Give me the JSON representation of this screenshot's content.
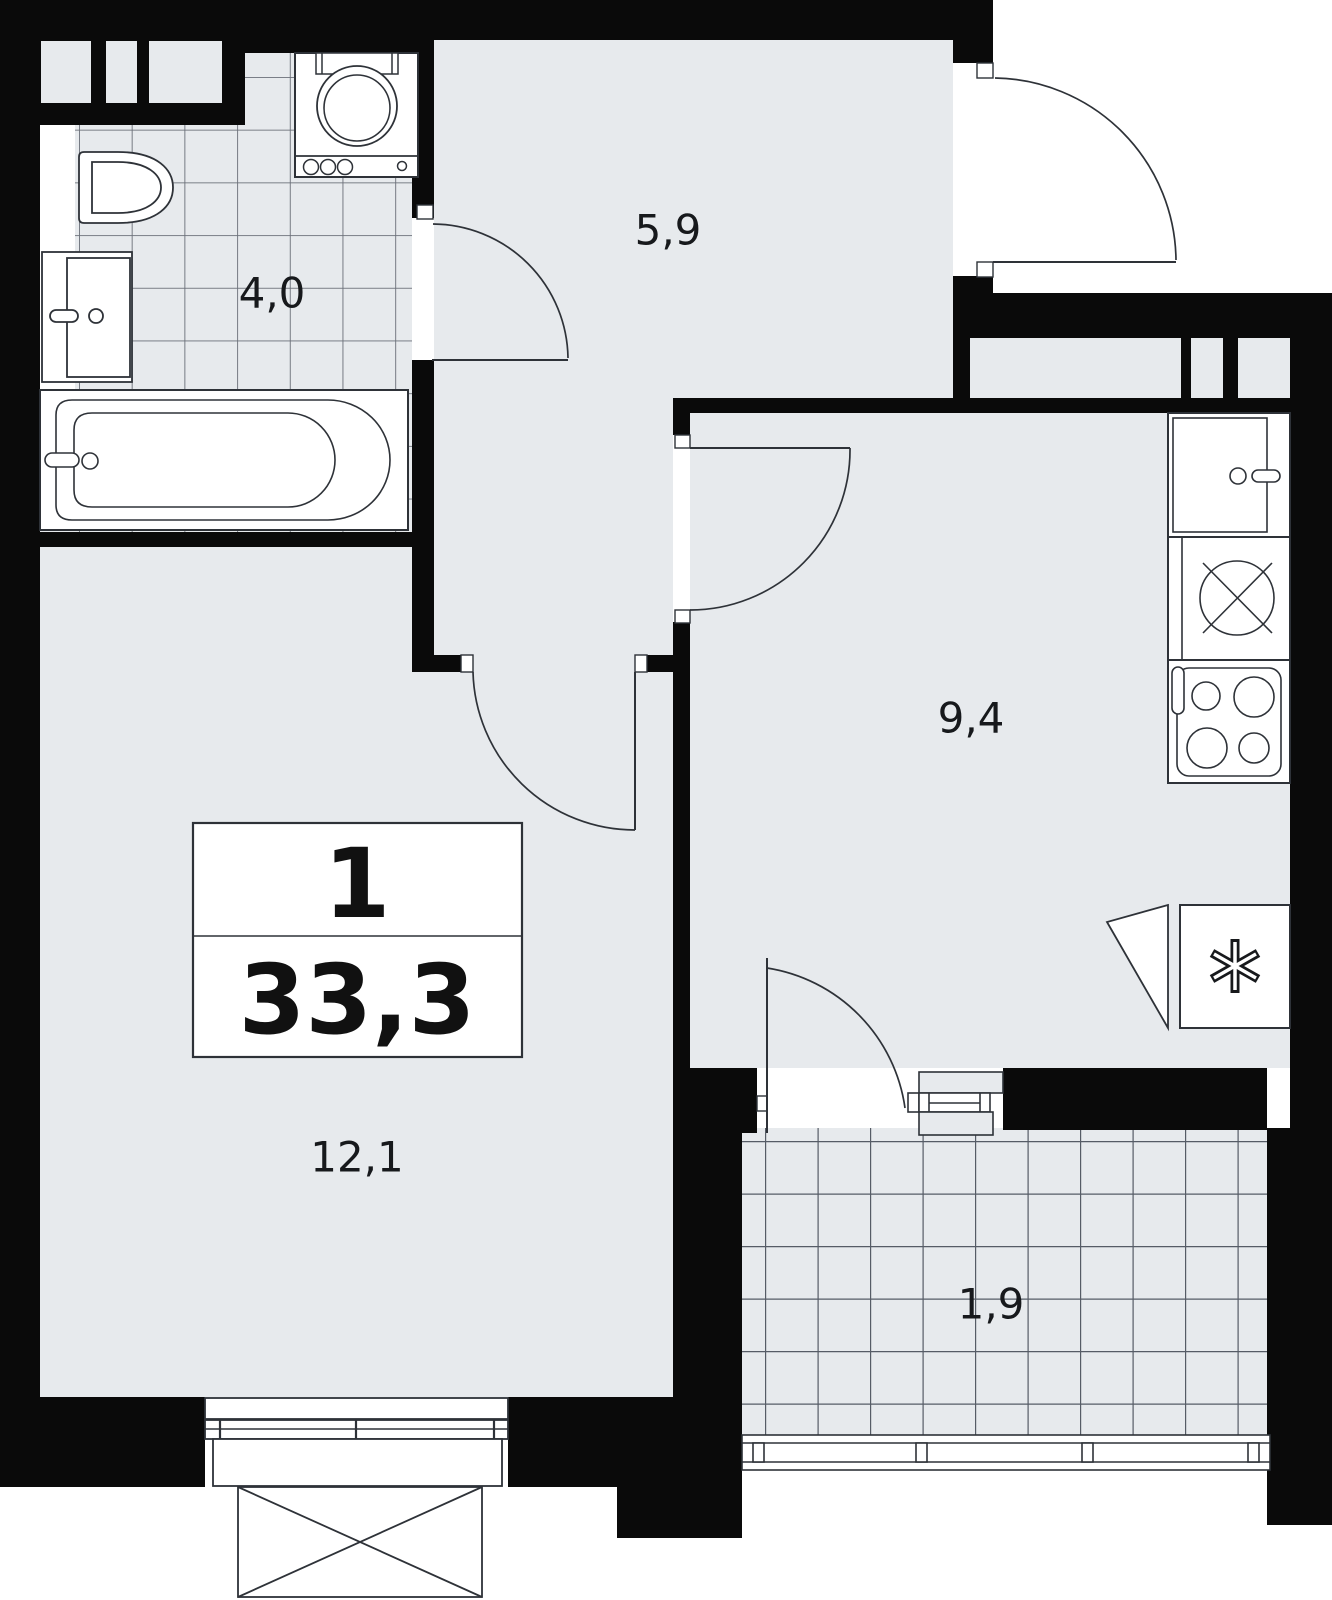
{
  "title": "1-room apartment floor plan",
  "summary": {
    "rooms_count": "1",
    "total_area": "33,3"
  },
  "rooms": [
    {
      "name": "bathroom",
      "area": "4,0"
    },
    {
      "name": "hallway",
      "area": "5,9"
    },
    {
      "name": "kitchen",
      "area": "9,4"
    },
    {
      "name": "living-room",
      "area": "12,1"
    },
    {
      "name": "balcony",
      "area": "1,9"
    }
  ],
  "icons": [
    "toilet-icon",
    "bath-sink-icon",
    "bathtub-icon",
    "washing-machine-icon",
    "kitchen-sink-icon",
    "hob-circle-icon",
    "stove-icon",
    "refrigerator-snowflake-icon",
    "door-swing-icon",
    "window-icon",
    "balcony-railing-icon"
  ],
  "colors": {
    "wall": "#0a0a0a",
    "floor": "#e7eaed",
    "fixture_line": "#2e3238",
    "tile_line": "#676d76",
    "background": "#ffffff"
  }
}
